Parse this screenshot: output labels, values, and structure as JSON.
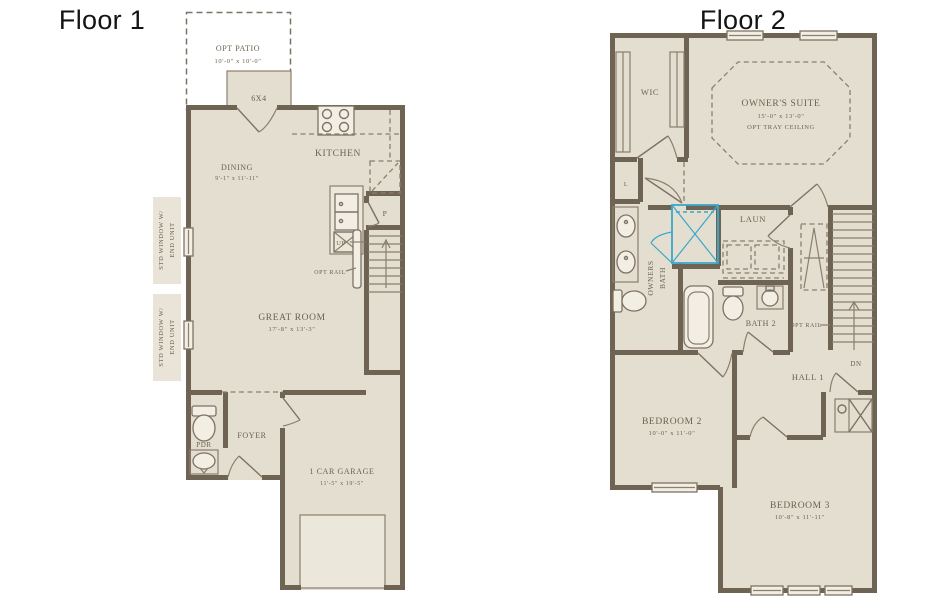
{
  "palette": {
    "background": "#ffffff",
    "wall": "#6f6354",
    "floor_fill": "#e3decf",
    "thin_line": "#8b7f6e",
    "label_text": "#6c6150",
    "title_text": "#141414",
    "accent_blue": "#3ba7cc"
  },
  "floor1": {
    "title": "Floor 1",
    "patio": {
      "label": "OPT PATIO",
      "dims": "10'-0\" x 10'-0\""
    },
    "pad": {
      "line1": "6X4",
      "line2": "PAD"
    },
    "dining": {
      "label": "DINING",
      "dims": "9'-1\" x 11'-11\""
    },
    "kitchen": {
      "label": "KITCHEN"
    },
    "pantry": {
      "label": "P"
    },
    "stairs": {
      "up": "UP",
      "opt_rail": "OPT RAIL"
    },
    "great_room": {
      "label": "GREAT ROOM",
      "dims": "17'-8\" x 13'-3\""
    },
    "window_note": {
      "line1": "STD WINDOW W/",
      "line2": "END UNIT"
    },
    "pdr": {
      "label": "PDR"
    },
    "foyer": {
      "label": "FOYER"
    },
    "garage": {
      "label": "1 CAR GARAGE",
      "dims": "11'-5\" x 19'-5\""
    }
  },
  "floor2": {
    "title": "Floor 2",
    "wic": {
      "label": "WIC"
    },
    "owners_suite": {
      "label": "OWNER'S SUITE",
      "dims": "15'-0\" x 13'-0\"",
      "note": "OPT TRAY CEILING"
    },
    "linen": {
      "label": "L"
    },
    "owners_bath": {
      "line1": "OWNERS",
      "line2": "BATH"
    },
    "laundry": {
      "label": "LAUN"
    },
    "bath2": {
      "label": "BATH 2"
    },
    "stairs": {
      "opt_rail": "OPT RAIL",
      "dn": "DN"
    },
    "hall": {
      "label": "HALL 1"
    },
    "bedroom2": {
      "label": "BEDROOM 2",
      "dims": "10'-0\" x 11'-0\""
    },
    "bedroom3": {
      "label": "BEDROOM 3",
      "dims": "10'-8\" x 11'-11\""
    }
  }
}
